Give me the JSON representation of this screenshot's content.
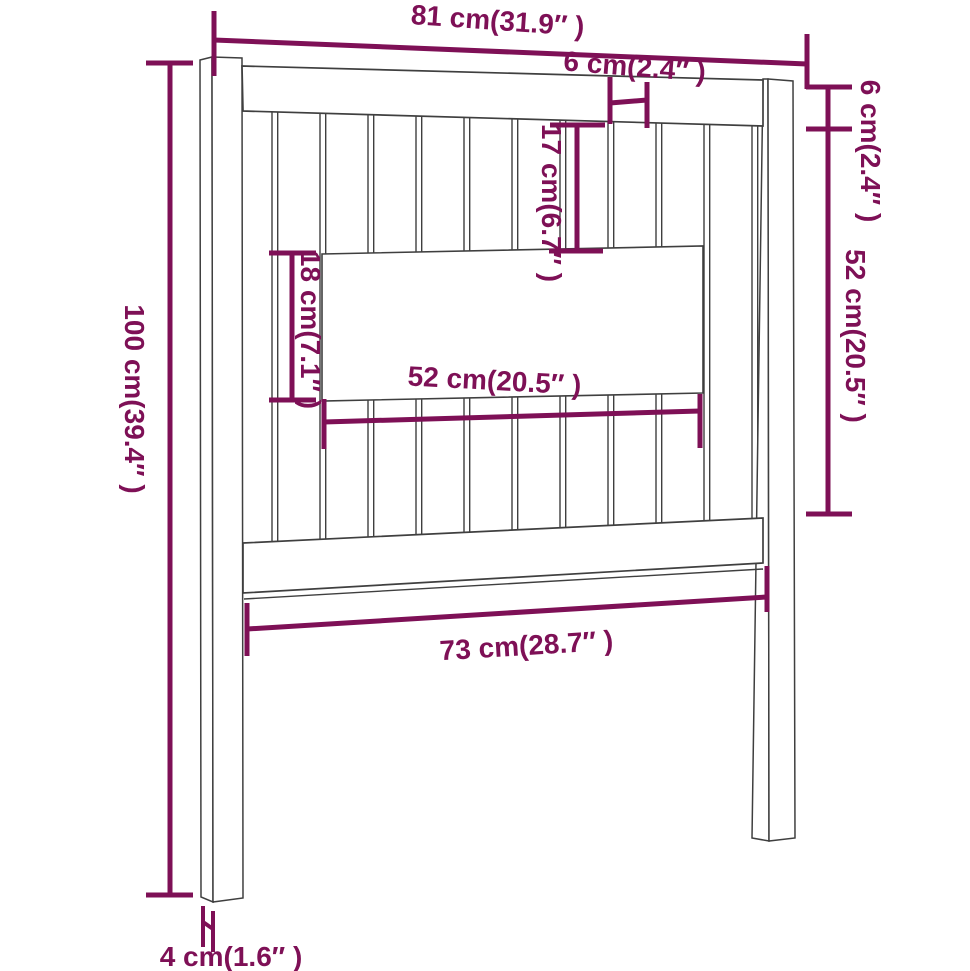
{
  "diagram": {
    "product": "headboard",
    "view": "front dimension drawing",
    "colors": {
      "dimension": "#7e1056",
      "outline": "#3f3f3f",
      "background": "#ffffff"
    },
    "dimensions": {
      "overall_width": "81 cm(31.9″ )",
      "slat_width": "6 cm(2.4″ )",
      "upper_gap_height": "17 cm(6.7″ )",
      "top_rail_thickness": "6 cm(2.4″ )",
      "rail_to_rail_height": "52 cm(20.5″ )",
      "middle_board_height": "18 cm(7.1″ )",
      "middle_board_width": "52 cm(20.5″ )",
      "overall_height": "100 cm(39.4″ )",
      "lower_rail_width": "73 cm(28.7″ )",
      "leg_thickness": "4 cm(1.6″ )"
    }
  }
}
